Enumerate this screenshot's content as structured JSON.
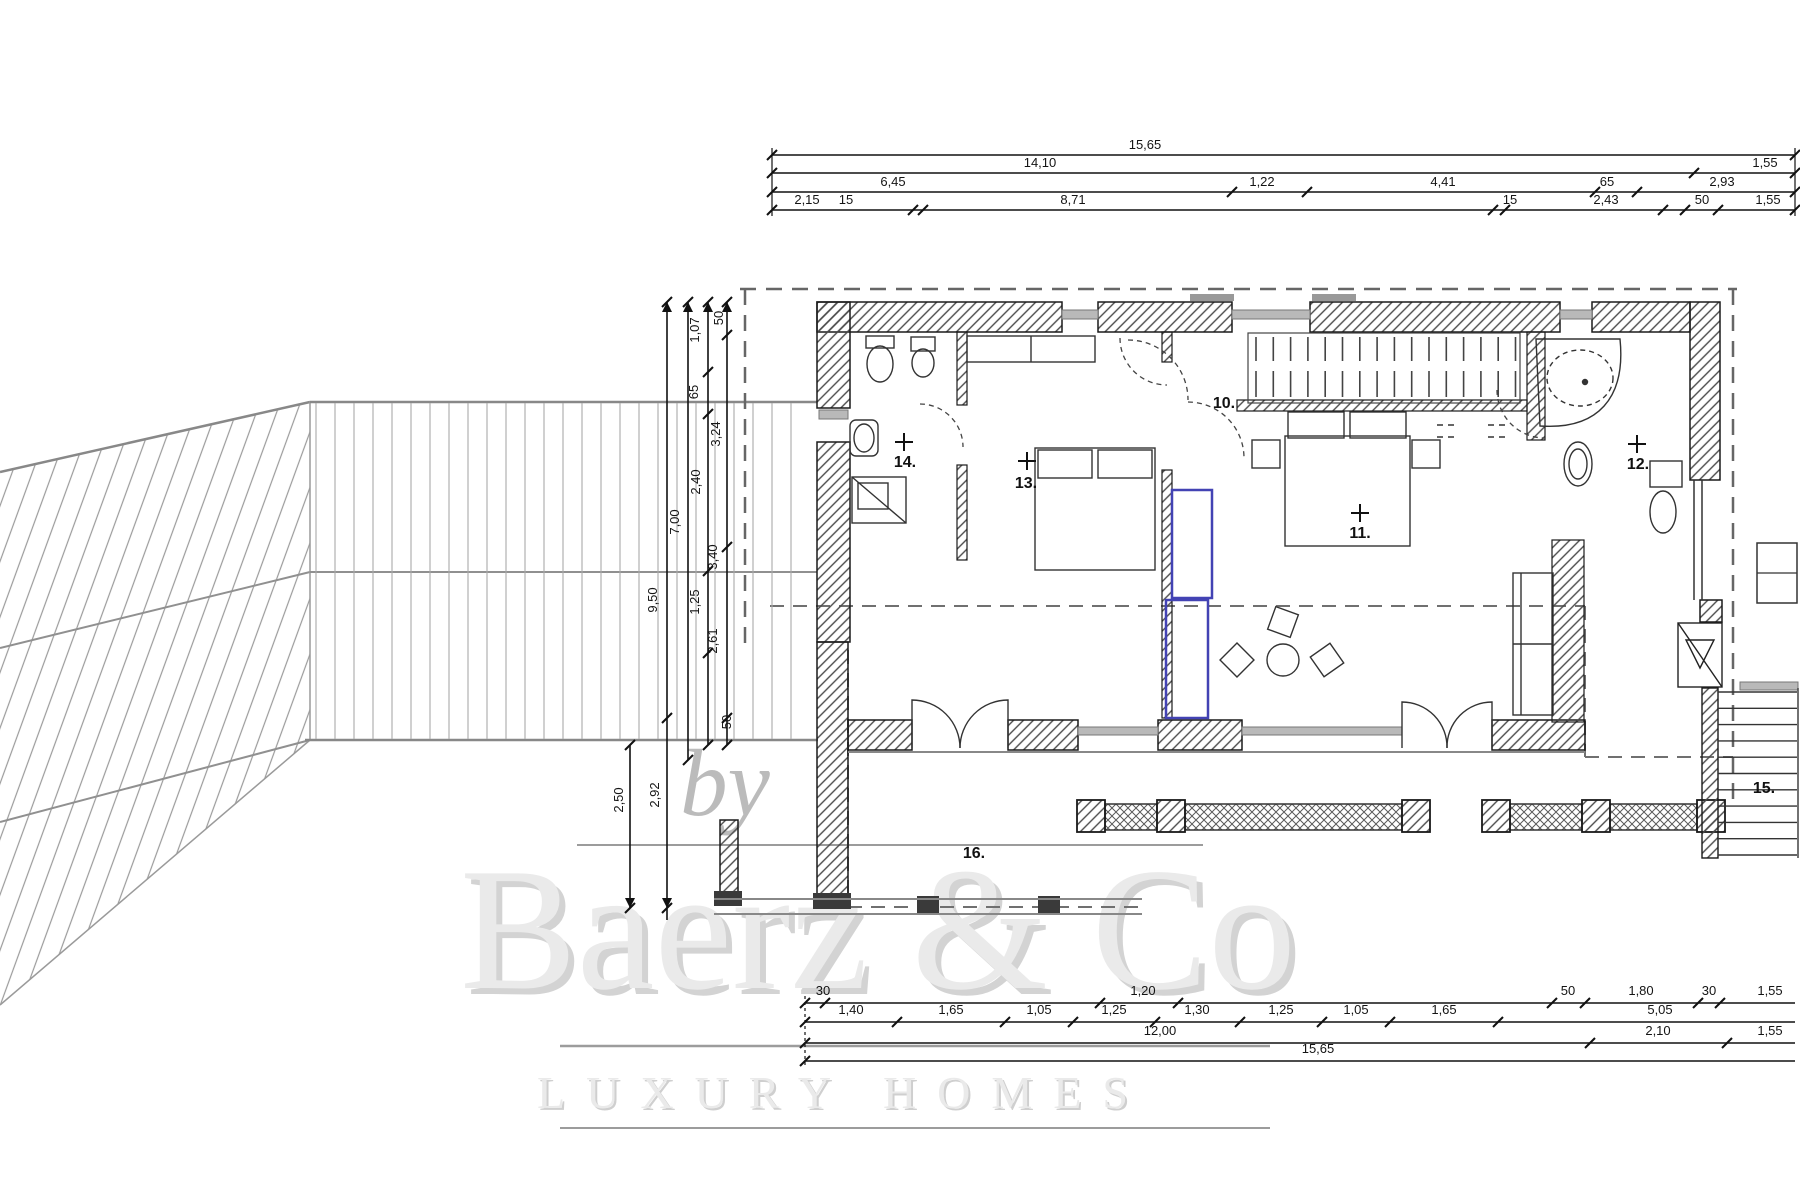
{
  "title": "floor-plan-drawing",
  "colors": {
    "line": "#1c1c1c",
    "wall": "#2a2a2a",
    "gray": "#8a8a8a",
    "lightgray": "#aaaaaa",
    "blue": "#4343b4",
    "watermark_fill": "#eaeaea",
    "watermark_shadow": "#b0b0b0",
    "watermark_rule": "#9c9c9c"
  },
  "rooms": [
    {
      "label": "10.",
      "x": 1212,
      "y": 408,
      "cross": null
    },
    {
      "label": "11.",
      "x": 1348,
      "y": 538,
      "cross": [
        1360,
        513
      ]
    },
    {
      "label": "12.",
      "x": 1626,
      "y": 469,
      "cross": [
        1637,
        444
      ]
    },
    {
      "label": "13.",
      "x": 1014,
      "y": 488,
      "cross": [
        1027,
        461
      ]
    },
    {
      "label": "14.",
      "x": 893,
      "y": 467,
      "cross": [
        904,
        442
      ]
    },
    {
      "label": "15.",
      "x": 1752,
      "y": 793,
      "cross": null
    },
    {
      "label": "16.",
      "x": 962,
      "y": 858,
      "cross": null
    }
  ],
  "dims_top": {
    "lines": [
      {
        "y": 155,
        "x1": 772,
        "x2": 1795
      },
      {
        "y": 173,
        "x1": 772,
        "x2": 1795
      },
      {
        "y": 192,
        "x1": 772,
        "x2": 1795
      },
      {
        "y": 210,
        "x1": 772,
        "x2": 1795
      }
    ],
    "ticks": [
      [
        772,
        155
      ],
      [
        1795,
        155
      ],
      [
        772,
        173
      ],
      [
        1694,
        173
      ],
      [
        1795,
        173
      ],
      [
        772,
        192
      ],
      [
        1232,
        192
      ],
      [
        1307,
        192
      ],
      [
        1595,
        192
      ],
      [
        1637,
        192
      ],
      [
        1795,
        192
      ],
      [
        772,
        210
      ],
      [
        913,
        210
      ],
      [
        923,
        210
      ],
      [
        1493,
        210
      ],
      [
        1505,
        210
      ],
      [
        1663,
        210
      ],
      [
        1685,
        210
      ],
      [
        1718,
        210
      ],
      [
        1795,
        210
      ]
    ],
    "labels": [
      {
        "t": "15,65",
        "x": 1145,
        "y": 149
      },
      {
        "t": "14,10",
        "x": 1040,
        "y": 167
      },
      {
        "t": "1,55",
        "x": 1765,
        "y": 167
      },
      {
        "t": "6,45",
        "x": 893,
        "y": 186
      },
      {
        "t": "1,22",
        "x": 1262,
        "y": 186
      },
      {
        "t": "4,41",
        "x": 1443,
        "y": 186
      },
      {
        "t": "65",
        "x": 1607,
        "y": 186
      },
      {
        "t": "2,93",
        "x": 1722,
        "y": 186
      },
      {
        "t": "2,15",
        "x": 807,
        "y": 204
      },
      {
        "t": "15",
        "x": 846,
        "y": 204
      },
      {
        "t": "8,71",
        "x": 1073,
        "y": 204
      },
      {
        "t": "15",
        "x": 1510,
        "y": 204
      },
      {
        "t": "2,43",
        "x": 1606,
        "y": 204
      },
      {
        "t": "50",
        "x": 1702,
        "y": 204
      },
      {
        "t": "1,55",
        "x": 1768,
        "y": 204
      }
    ]
  },
  "dims_bottom": {
    "lines": [
      {
        "y": 1003,
        "x1": 805,
        "x2": 1795
      },
      {
        "y": 1022,
        "x1": 805,
        "x2": 1795
      },
      {
        "y": 1043,
        "x1": 805,
        "x2": 1795
      },
      {
        "y": 1061,
        "x1": 805,
        "x2": 1795
      }
    ],
    "ticks": [
      [
        805,
        1003
      ],
      [
        825,
        1003
      ],
      [
        1100,
        1003
      ],
      [
        1178,
        1003
      ],
      [
        1552,
        1003
      ],
      [
        1585,
        1003
      ],
      [
        1698,
        1003
      ],
      [
        1720,
        1003
      ],
      [
        805,
        1022
      ],
      [
        897,
        1022
      ],
      [
        1005,
        1022
      ],
      [
        1073,
        1022
      ],
      [
        1155,
        1022
      ],
      [
        1240,
        1022
      ],
      [
        1322,
        1022
      ],
      [
        1390,
        1022
      ],
      [
        1498,
        1022
      ],
      [
        805,
        1043
      ],
      [
        1590,
        1043
      ],
      [
        1727,
        1043
      ],
      [
        805,
        1061
      ]
    ],
    "labels": [
      {
        "t": "30",
        "x": 823,
        "y": 995
      },
      {
        "t": "1,20",
        "x": 1143,
        "y": 995
      },
      {
        "t": "50",
        "x": 1568,
        "y": 995
      },
      {
        "t": "1,80",
        "x": 1641,
        "y": 995
      },
      {
        "t": "30",
        "x": 1709,
        "y": 995
      },
      {
        "t": "1,55",
        "x": 1770,
        "y": 995
      },
      {
        "t": "1,40",
        "x": 851,
        "y": 1014
      },
      {
        "t": "1,65",
        "x": 951,
        "y": 1014
      },
      {
        "t": "1,05",
        "x": 1039,
        "y": 1014
      },
      {
        "t": "1,25",
        "x": 1114,
        "y": 1014
      },
      {
        "t": "1,30",
        "x": 1197,
        "y": 1014
      },
      {
        "t": "1,25",
        "x": 1281,
        "y": 1014
      },
      {
        "t": "1,05",
        "x": 1356,
        "y": 1014
      },
      {
        "t": "1,65",
        "x": 1444,
        "y": 1014
      },
      {
        "t": "5,05",
        "x": 1660,
        "y": 1014
      },
      {
        "t": "12,00",
        "x": 1160,
        "y": 1035
      },
      {
        "t": "2,10",
        "x": 1658,
        "y": 1035
      },
      {
        "t": "1,55",
        "x": 1770,
        "y": 1035
      },
      {
        "t": "15,65",
        "x": 1318,
        "y": 1053
      }
    ]
  },
  "dims_left": {
    "lines": [
      {
        "x": 667,
        "y1": 302,
        "y2": 920
      },
      {
        "x": 688,
        "y1": 302,
        "y2": 760
      },
      {
        "x": 708,
        "y1": 302,
        "y2": 745
      },
      {
        "x": 727,
        "y1": 302,
        "y2": 745
      },
      {
        "x": 630,
        "y1": 745,
        "y2": 908
      }
    ],
    "ticks": [
      [
        667,
        302
      ],
      [
        667,
        718
      ],
      [
        667,
        908
      ],
      [
        688,
        302
      ],
      [
        688,
        760
      ],
      [
        708,
        302
      ],
      [
        708,
        372
      ],
      [
        708,
        414
      ],
      [
        708,
        571
      ],
      [
        708,
        653
      ],
      [
        708,
        745
      ],
      [
        727,
        302
      ],
      [
        727,
        335
      ],
      [
        727,
        547
      ],
      [
        727,
        718
      ],
      [
        727,
        745
      ],
      [
        630,
        745
      ],
      [
        630,
        908
      ]
    ],
    "arrows_up": [
      [
        667,
        302
      ],
      [
        688,
        302
      ],
      [
        708,
        302
      ],
      [
        727,
        302
      ]
    ],
    "arrows_down": [
      [
        630,
        908
      ],
      [
        667,
        908
      ]
    ],
    "labels": [
      {
        "t": "9,50",
        "x": 657,
        "y": 600
      },
      {
        "t": "7,00",
        "x": 679,
        "y": 522
      },
      {
        "t": "2,92",
        "x": 659,
        "y": 795
      },
      {
        "t": "2,50",
        "x": 623,
        "y": 800
      },
      {
        "t": "1,07",
        "x": 699,
        "y": 330
      },
      {
        "t": "65",
        "x": 698,
        "y": 392
      },
      {
        "t": "2,40",
        "x": 700,
        "y": 482
      },
      {
        "t": "1,25",
        "x": 699,
        "y": 602
      },
      {
        "t": "50",
        "x": 723,
        "y": 318
      },
      {
        "t": "3,24",
        "x": 720,
        "y": 434
      },
      {
        "t": "3,40",
        "x": 717,
        "y": 557
      },
      {
        "t": "2,61",
        "x": 717,
        "y": 641
      },
      {
        "t": "50",
        "x": 731,
        "y": 722
      }
    ]
  },
  "watermark": {
    "by": "by",
    "brand": "Baerz & Co",
    "tagline": "LUXURY HOMES"
  }
}
